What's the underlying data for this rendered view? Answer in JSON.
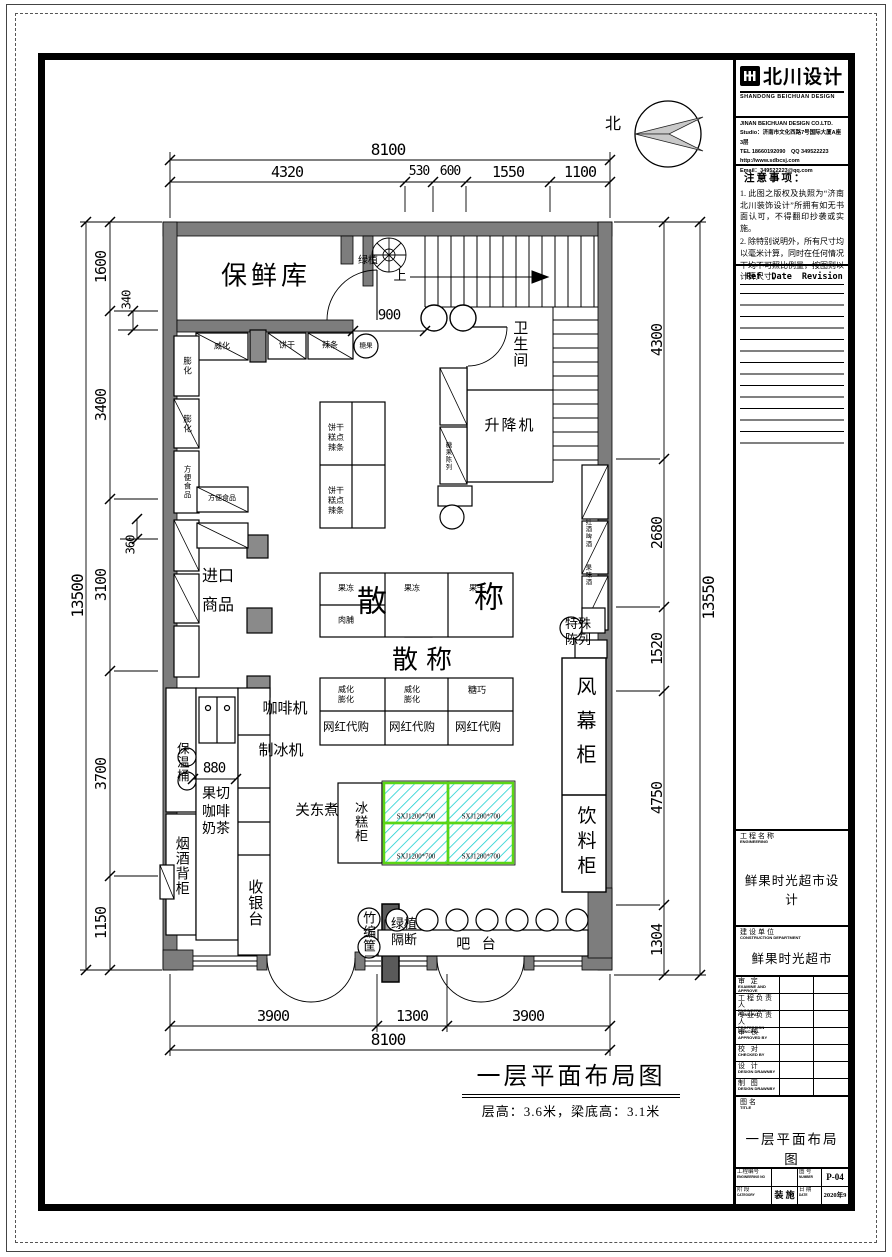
{
  "colors": {
    "wall": "#7d7d7d",
    "freezer_border": "#5bd516",
    "freezer_hatch": "#1ad0d0"
  },
  "compass_label": "北",
  "caption": {
    "title": "一层平面布局图",
    "subtitle": "层高：3.6米，梁底高：3.1米"
  },
  "dims": {
    "top_total": "8100",
    "top": [
      "4320",
      "530",
      "600",
      "1550",
      "1100"
    ],
    "left_total": "13500",
    "left": [
      "1600",
      "3400",
      "3100",
      "3700",
      "1150"
    ],
    "left_small": [
      "340",
      "360"
    ],
    "right_total": "13550",
    "right": [
      "4300",
      "2680",
      "1520",
      "4750",
      "1304"
    ],
    "bottom": [
      "3900",
      "1300",
      "3900"
    ],
    "bottom_total": "8100",
    "door_900": "900",
    "counter_880": "880"
  },
  "rooms": {
    "fresh_store": "保鲜库",
    "toilet": "卫生间",
    "lift": "升降机",
    "up_arrow": "上"
  },
  "fixtures": {
    "plant": "绿植",
    "weihua": "威化",
    "binggan": "饼干",
    "latiao": "辣条",
    "tangguo": "糖果",
    "penghua": "膨化",
    "fangbian": "方便食品",
    "imported": [
      "进口",
      "商品"
    ],
    "gondola_cell": [
      "饼干",
      "糕点",
      "辣条"
    ],
    "jelly": "果冻",
    "jerky": "肉脯",
    "dried_fruit": "果干",
    "san": "散",
    "cheng": "称",
    "sancheng": "散称",
    "wafer_puff": [
      "威化",
      "膨化"
    ],
    "tangqiao": "糖巧",
    "daigou": "网红代购",
    "ice_cabinet": "冰糕柜",
    "freezer_model": "SXJ1200*700",
    "air_curtain": "风幕柜",
    "drink_cabinet": "饮料柜",
    "special_display": [
      "特殊",
      "陈列"
    ],
    "wine_beer": "红酒啤酒",
    "fruit_wine": "果味酒",
    "candy_shelf": "糖果陈列",
    "coffee_machine": "咖啡机",
    "ice_maker": "制冰机",
    "thermos": "保温桶",
    "tobacco": "烟酒背柜",
    "fruit_coffee_tea": [
      "果切",
      "咖啡",
      "奶茶"
    ],
    "oden": "关东煮",
    "cashier": "收银台",
    "bar": "吧 台",
    "basket": "竹编筐",
    "plant_partition": [
      "绿植",
      "隔断"
    ]
  },
  "title_block": {
    "logo_text": "北川设计",
    "logo_sub": "SHANDONG BEICHUAN DESIGN",
    "company_lines": [
      "JINAN BEICHUAN DESIGN CO.LTD.",
      "Studio：济南市文化西路7号国际大厦A座3层",
      "TEL 18660192090　QQ 349522223",
      "http://www.sdbcsj.com",
      "Email：349522223@qq.com"
    ],
    "notes_title": "注意事项：",
    "notes": [
      "1. 此图之版权及执照为“济南北川装饰设计”所拥有如无书面认可，不得翻印抄袭或实施。",
      "2. 除特别说明外，所有尺寸均以毫米计算，同时在任何情况下均不可照比例量，按图则以计算尺寸。"
    ],
    "revision_headers": [
      "Ref",
      "Date",
      "Revision"
    ],
    "engineering_label": "工程名称",
    "engineering_label_en": "ENGINEERING",
    "engineering_value": "鲜果时光超市设计",
    "construction_label": "建设单位",
    "construction_label_en": "CONSTRUCTION DEPARTMENT",
    "construction_value": "鲜果时光超市",
    "signoff_rows": [
      {
        "cn": "审 定",
        "en": "EXAMINE AND APPROVE"
      },
      {
        "cn": "工程负责人",
        "en": "ENGINEERING PRINCIPAL"
      },
      {
        "cn": "专业负责人",
        "en": "PROFESSION PRINCIPAL"
      },
      {
        "cn": "审 核",
        "en": "APPROVED BY"
      },
      {
        "cn": "校 对",
        "en": "CHECKED BY"
      },
      {
        "cn": "设 计",
        "en": "DESIGN DRAWNBY"
      },
      {
        "cn": "制 图",
        "en": "DESIGN DRAWNBY"
      }
    ],
    "title_label": "图名",
    "title_label_en": "TITLE",
    "title_value": "一层平面布局图",
    "footer": {
      "eng_no_label": "工程编号",
      "eng_no_label_en": "ENGINEERING NO",
      "number_label": "图 号",
      "number_label_en": "NUMBER",
      "number_value": "P-04",
      "stage_label": "阶 段",
      "stage_label_en": "CATEGORY",
      "stage_value": "装 施",
      "date_label": "日 期",
      "date_label_en": "DATE",
      "date_value": "2020年9月"
    }
  }
}
